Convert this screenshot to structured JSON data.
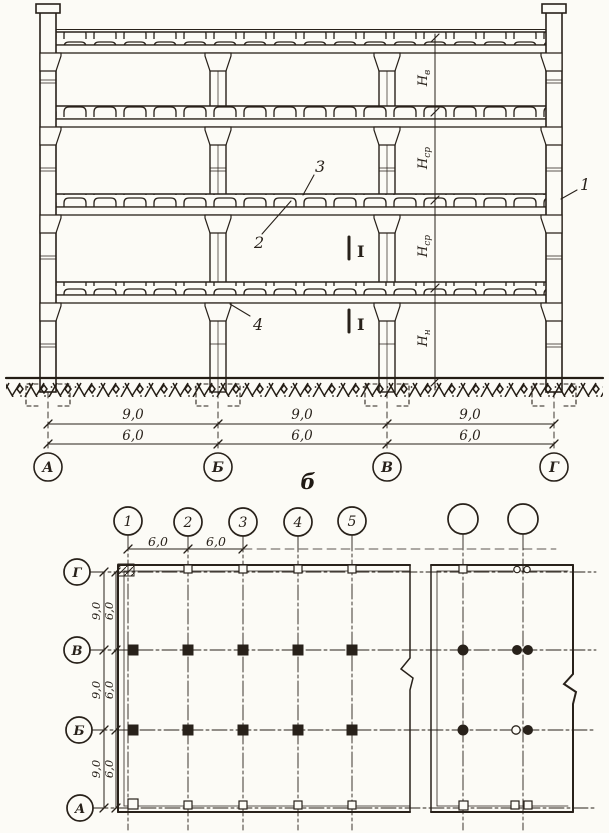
{
  "caption": "б",
  "section": {
    "axis_labels": [
      "А",
      "Б",
      "В",
      "Г"
    ],
    "dim_row_top": [
      "9,0",
      "9,0",
      "9,0"
    ],
    "dim_row_bottom": [
      "6,0",
      "6,0",
      "6,0"
    ],
    "height_labels": [
      {
        "base": "Н",
        "sub": "в"
      },
      {
        "base": "Н",
        "sub": "ср"
      },
      {
        "base": "Н",
        "sub": "ср"
      },
      {
        "base": "Н",
        "sub": "н"
      }
    ],
    "callouts": {
      "wall_panel": "1",
      "beam": "2",
      "slab": "3",
      "column_joint": "4"
    },
    "section_mark": "I"
  },
  "plan": {
    "column_axis_labels": [
      "1",
      "2",
      "3",
      "4",
      "5"
    ],
    "row_axis_labels": [
      "Г",
      "В",
      "Б",
      "А"
    ],
    "top_dims": [
      "6,0",
      "6,0"
    ],
    "left_dims_outer": [
      "9,0",
      "9,0",
      "9,0"
    ],
    "left_dims_inner": [
      "6,0",
      "6,0",
      "6,0"
    ]
  }
}
